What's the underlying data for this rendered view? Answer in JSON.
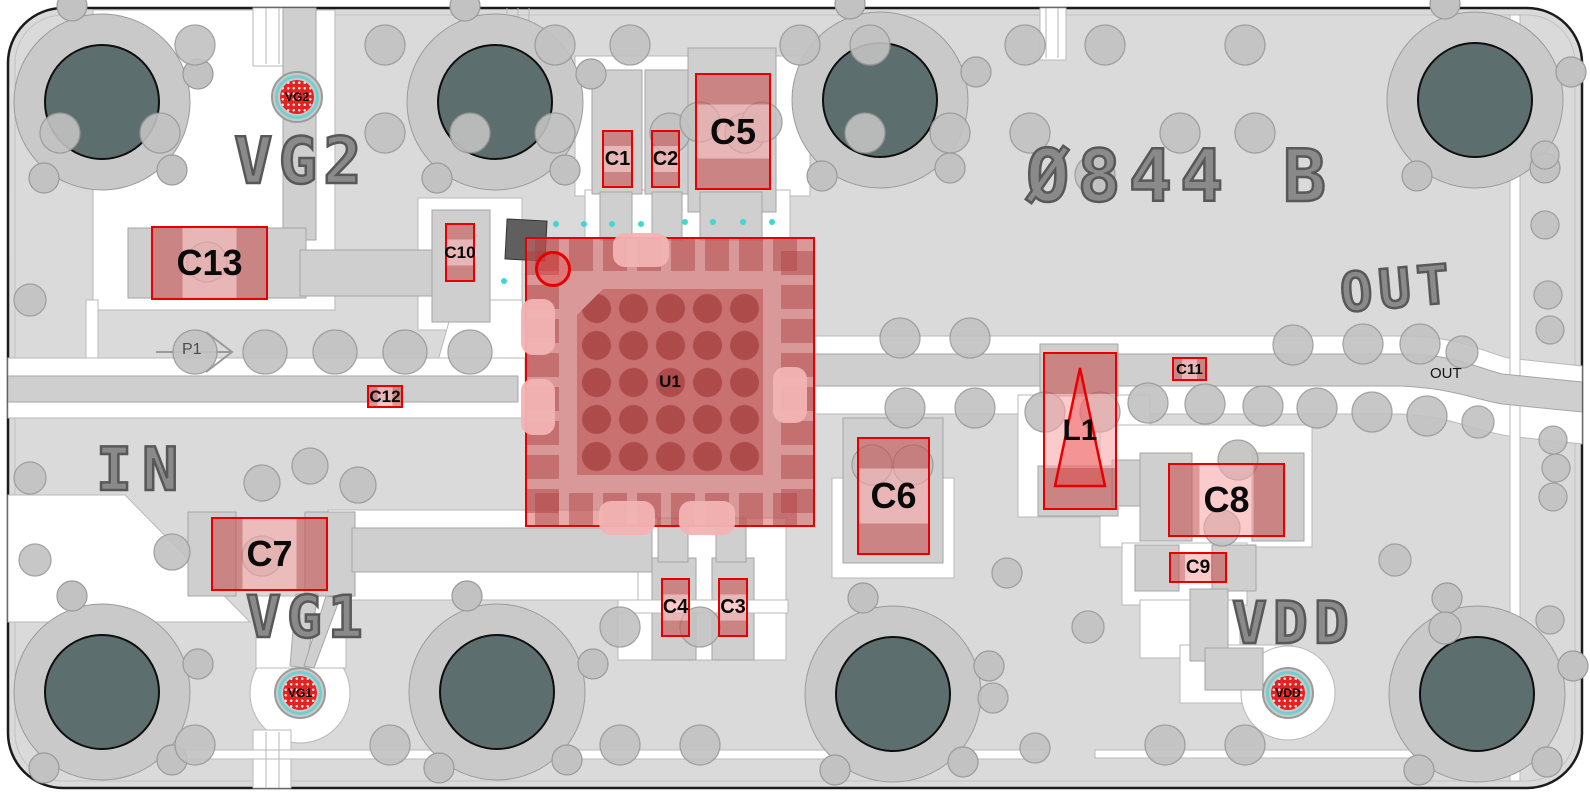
{
  "silkscreen": {
    "vg2": "VG2",
    "in": "IN",
    "vg1": "VG1",
    "board_id": "Ø844 B",
    "out_big": "OUT",
    "vdd": "VDD",
    "p1": "P1",
    "out_trace": "OUT"
  },
  "components": [
    {
      "id": "C1",
      "label": "C1"
    },
    {
      "id": "C2",
      "label": "C2"
    },
    {
      "id": "C5",
      "label": "C5"
    },
    {
      "id": "C13",
      "label": "C13"
    },
    {
      "id": "C10",
      "label": "C10"
    },
    {
      "id": "C12",
      "label": "C12"
    },
    {
      "id": "U1",
      "label": "U1"
    },
    {
      "id": "C11",
      "label": "C11"
    },
    {
      "id": "L1",
      "label": "L1"
    },
    {
      "id": "C6",
      "label": "C6"
    },
    {
      "id": "C7",
      "label": "C7"
    },
    {
      "id": "C8",
      "label": "C8"
    },
    {
      "id": "C9",
      "label": "C9"
    },
    {
      "id": "C4",
      "label": "C4"
    },
    {
      "id": "C3",
      "label": "C3"
    }
  ],
  "testpoints": [
    {
      "id": "VG2",
      "label": "VG2"
    },
    {
      "id": "VG1",
      "label": "VG1"
    },
    {
      "id": "VDD",
      "label": "VDD"
    }
  ],
  "colors": {
    "highlight": "#e80000",
    "highlight_fill": "#f08a8a",
    "board_copper": "#dadada",
    "drill_hole": "#5c6e6d",
    "testpoint_red": "#e32222",
    "testpoint_ring": "#72cfcf",
    "silkscreen": "#8a8a8a"
  }
}
